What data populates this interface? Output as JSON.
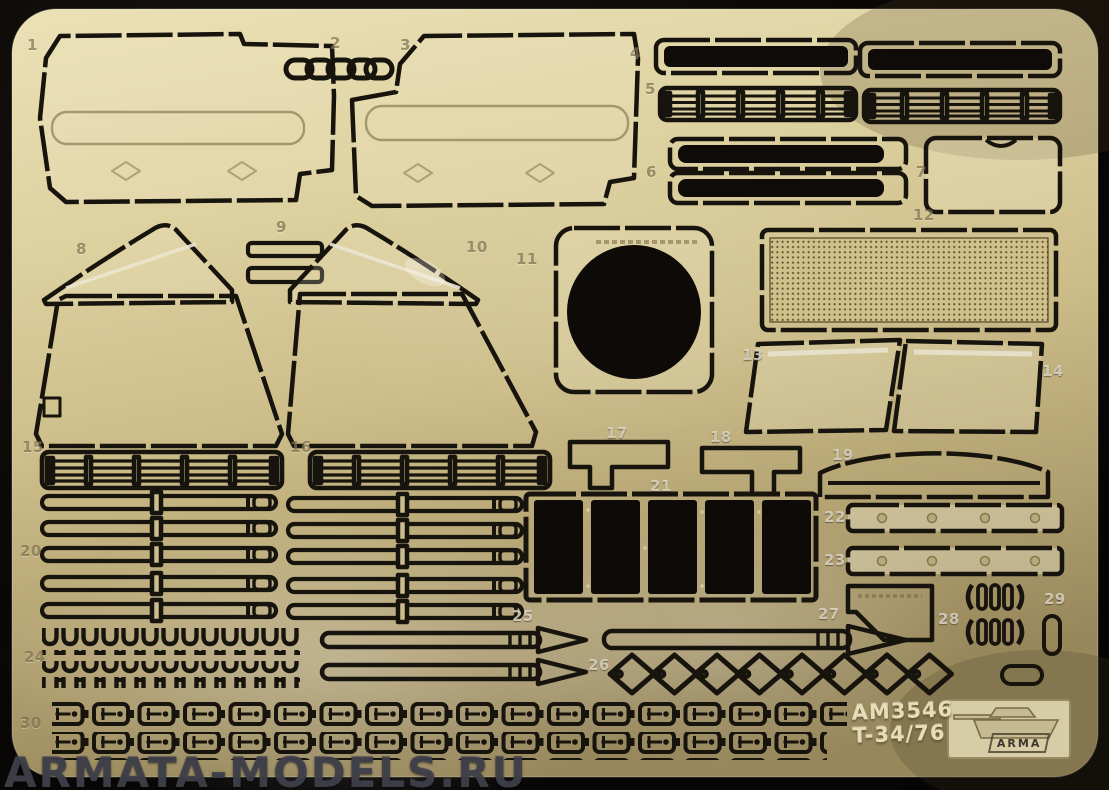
{
  "title": "Photo-etched brass detail fret on black background",
  "sheet": {
    "code": "AM3546",
    "subject": "T-34/76",
    "brand": "ARMA"
  },
  "watermark": "ARMATA-MODELS.RU",
  "parts": [
    "1",
    "2",
    "3",
    "4",
    "5",
    "6",
    "7",
    "8",
    "9",
    "10",
    "11",
    "12",
    "13",
    "14",
    "15",
    "16",
    "17",
    "18",
    "19",
    "20",
    "21",
    "22",
    "23",
    "24",
    "25",
    "26",
    "27",
    "28",
    "29",
    "30"
  ],
  "colors": {
    "background": "#070605",
    "brass_light": "#e9dfb4",
    "brass_mid": "#cdbe8a",
    "brass_dark": "#96865a",
    "etch_black": "#17130d",
    "watermark_gray": "#40404b"
  },
  "icons": [
    "tank-logo-icon"
  ]
}
